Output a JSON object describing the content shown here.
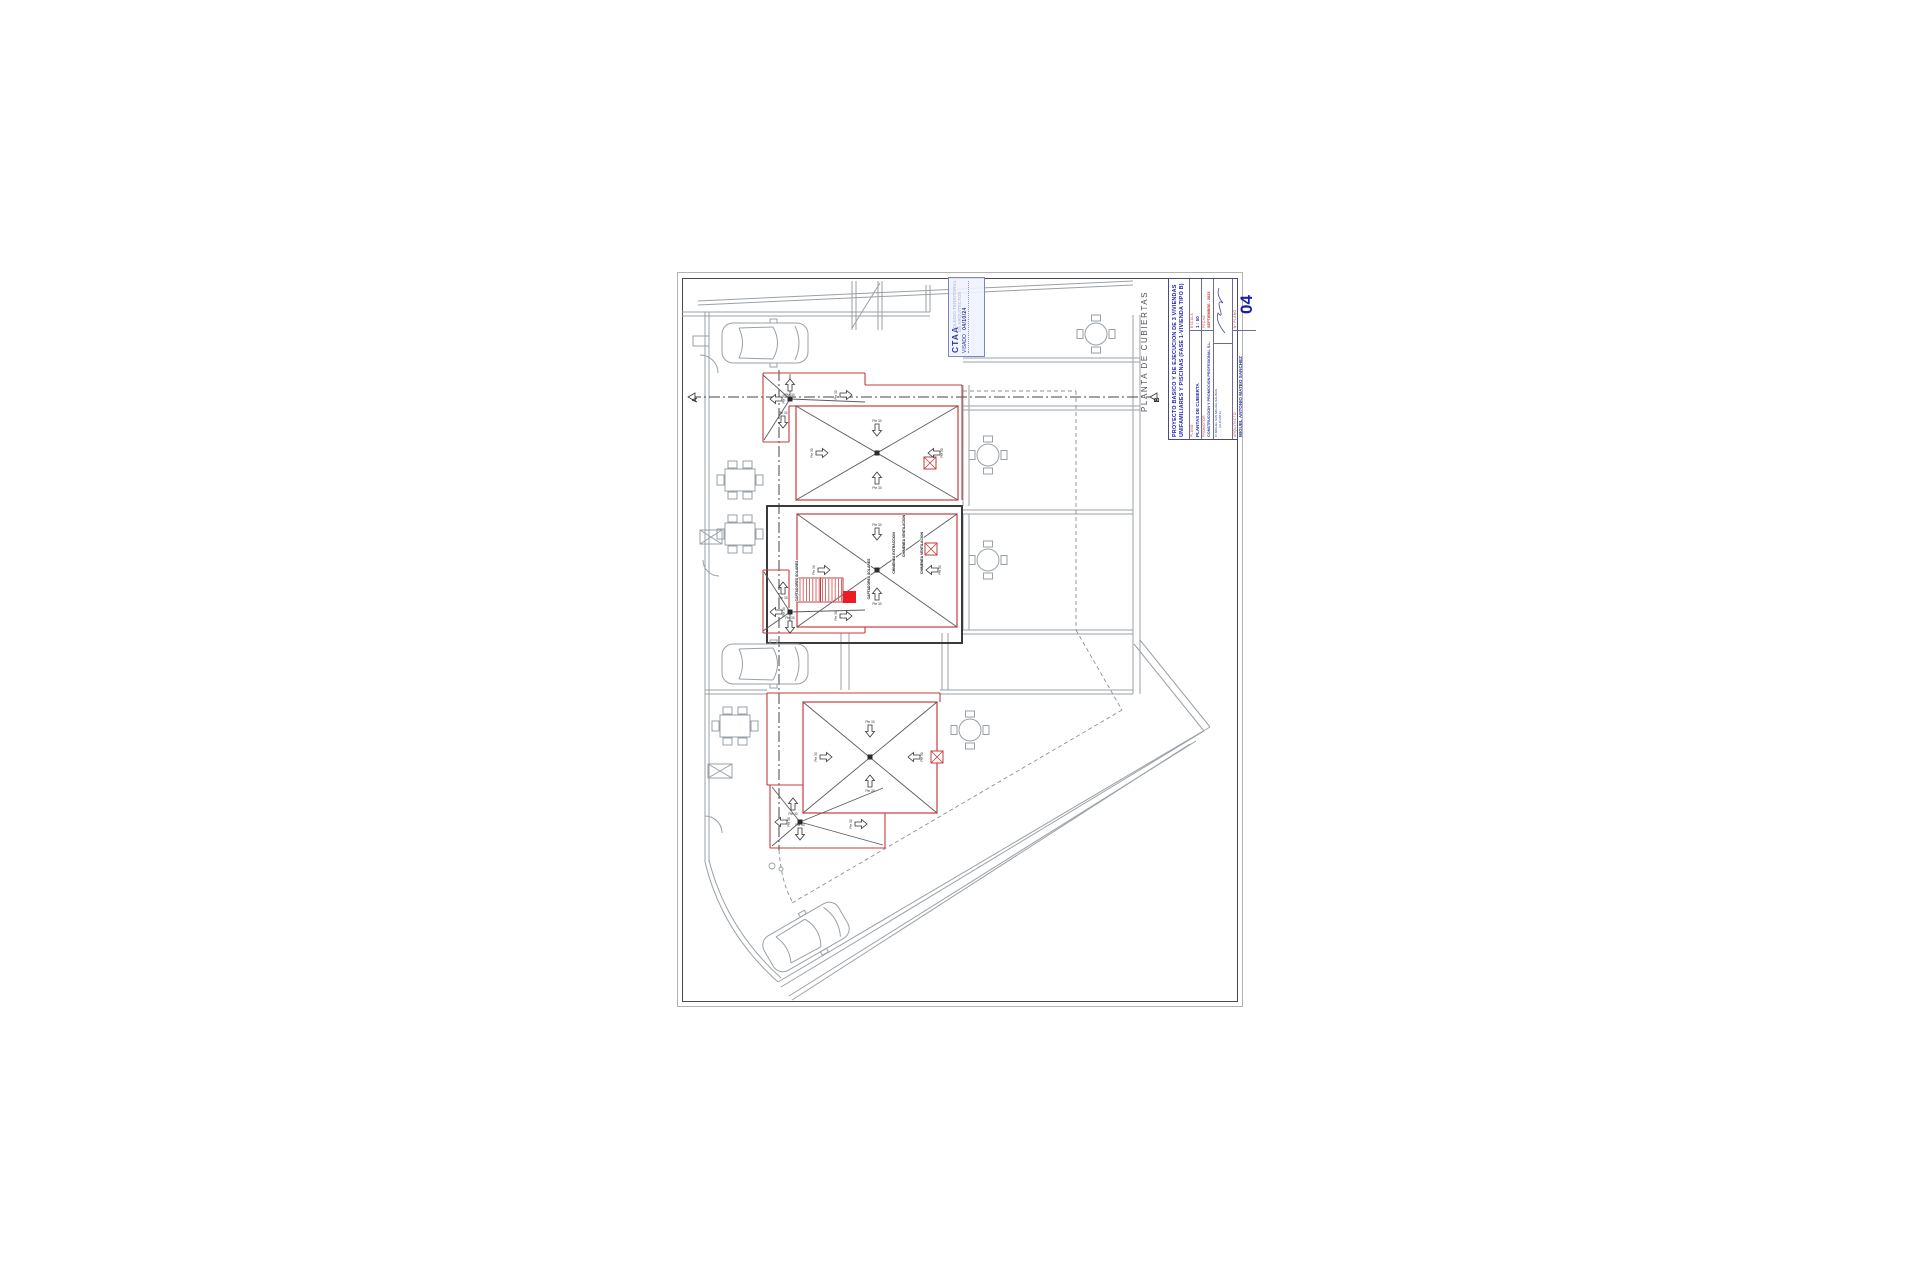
{
  "document": {
    "kind": "architectural roof plan sheet",
    "background": "#ffffff",
    "accent_red": "#c43c3c",
    "fill_red": "#ed1c24",
    "blue": "#1c1ca8"
  },
  "plan": {
    "label": "PLANTA DE CUBIERTAS",
    "slope_label": "Pte 30",
    "section_markers": {
      "left": "A",
      "right": "B"
    },
    "roof_tags": [
      {
        "x": 905,
        "y": 536,
        "text": "CHIMENEA VENTILACION"
      },
      {
        "x": 895,
        "y": 553,
        "text": "CHIMENEA EXTRACCION"
      },
      {
        "x": 923,
        "y": 553,
        "text": "CHIMENEA VENTILACION"
      },
      {
        "x": 870,
        "y": 579,
        "text": "CAPTADORES SOLARES"
      },
      {
        "x": 798,
        "y": 581,
        "text": "CAPTADORES SOLARES"
      }
    ],
    "geometry": {
      "gray_lines": [
        [
          698,
          301,
          1133,
          281
        ],
        [
          698,
          305,
          1133,
          285
        ],
        [
          682,
          312,
          930,
          312
        ],
        [
          682,
          316,
          930,
          316
        ],
        [
          705,
          312,
          705,
          862
        ],
        [
          709,
          312,
          709,
          862
        ],
        [
          852,
          281,
          852,
          330
        ],
        [
          856,
          281,
          856,
          330
        ],
        [
          878,
          281,
          878,
          330
        ],
        [
          882,
          281,
          882,
          330
        ],
        [
          926,
          285,
          926,
          312
        ],
        [
          930,
          285,
          930,
          312
        ],
        [
          852,
          328,
          880,
          283
        ],
        [
          963,
          358,
          1140,
          358
        ],
        [
          963,
          362,
          1140,
          362
        ],
        [
          1133,
          315,
          1133,
          694
        ],
        [
          1140,
          315,
          1140,
          694
        ],
        [
          962,
          406,
          1140,
          406
        ],
        [
          962,
          410,
          1140,
          410
        ],
        [
          962,
          510,
          1133,
          510
        ],
        [
          962,
          514,
          1133,
          514
        ],
        [
          962,
          630,
          1133,
          630
        ],
        [
          962,
          634,
          1133,
          634
        ],
        [
          940,
          690,
          1133,
          690
        ],
        [
          940,
          694,
          1133,
          694
        ],
        [
          705,
          690,
          767,
          690
        ],
        [
          705,
          694,
          767,
          694
        ],
        [
          963,
          385,
          963,
          506
        ],
        [
          969,
          385,
          969,
          506
        ],
        [
          963,
          514,
          963,
          630
        ],
        [
          969,
          514,
          969,
          630
        ],
        [
          841,
          633,
          841,
          690
        ],
        [
          849,
          633,
          849,
          690
        ],
        [
          942,
          633,
          942,
          690
        ],
        [
          948,
          633,
          948,
          690
        ],
        [
          1140,
          640,
          1210,
          727
        ],
        [
          1134,
          644,
          1204,
          731
        ],
        [
          778,
          982,
          1210,
          727
        ],
        [
          781,
          987,
          1204,
          731
        ],
        [
          789,
          996,
          1196,
          741
        ],
        [
          792,
          1000,
          1190,
          744
        ],
        [
          700,
          530,
          722,
          544
        ],
        [
          700,
          544,
          722,
          530
        ],
        [
          708,
          764,
          732,
          778
        ],
        [
          708,
          778,
          732,
          764
        ]
      ],
      "gray_rects": [
        [
          693,
          336,
          16,
          10
        ],
        [
          700,
          530,
          22,
          14
        ],
        [
          708,
          764,
          24,
          14
        ]
      ],
      "gray_paths": [
        "M700,355 a18,18 0 0 1 18,18",
        "M703,560 a16,16 0 0 0 16,16",
        "M705,816 a17,17 0 0 1 17,17",
        "M705,862 Q722,932 778,982",
        "M709,860 Q726,928 781,978"
      ],
      "dash_lines": [
        [
          963,
          391,
          1076,
          391
        ],
        [
          1076,
          391,
          1076,
          630
        ],
        [
          1076,
          630,
          1122,
          710
        ],
        [
          1122,
          710,
          792,
          903
        ]
      ],
      "dash_paths": [
        "M779,850 Q781,882 793,903"
      ],
      "dashdot_lines": [
        [
          690,
          397,
          1160,
          397
        ],
        [
          779,
          370,
          779,
          850
        ]
      ],
      "red_rects": [
        [
          796,
          406,
          162,
          94
        ],
        [
          797,
          514,
          160,
          113
        ],
        [
          803,
          702,
          134,
          111
        ]
      ],
      "red_lines": [
        [
          763,
          373,
          865,
          373
        ],
        [
          763,
          373,
          763,
          442
        ],
        [
          763,
          442,
          789,
          442
        ],
        [
          789,
          442,
          789,
          406
        ],
        [
          789,
          406,
          796,
          406
        ],
        [
          865,
          373,
          865,
          385
        ],
        [
          865,
          385,
          962,
          385
        ],
        [
          962,
          385,
          962,
          500
        ],
        [
          763,
          633,
          865,
          633
        ],
        [
          763,
          570,
          763,
          633
        ],
        [
          763,
          570,
          789,
          570
        ],
        [
          789,
          570,
          789,
          608
        ],
        [
          865,
          627,
          865,
          633
        ],
        [
          770,
          785,
          770,
          848
        ],
        [
          770,
          848,
          885,
          848
        ],
        [
          770,
          785,
          803,
          785
        ],
        [
          885,
          848,
          885,
          813
        ],
        [
          767,
          693,
          940,
          693
        ],
        [
          767,
          693,
          767,
          785
        ],
        [
          767,
          785,
          770,
          785
        ],
        [
          940,
          693,
          940,
          702
        ]
      ],
      "black_rects": [
        [
          767,
          506,
          195,
          137
        ]
      ],
      "thin_black": [
        [
          796,
          406,
          958,
          500
        ],
        [
          958,
          406,
          796,
          500
        ],
        [
          797,
          514,
          957,
          627
        ],
        [
          957,
          514,
          797,
          627
        ],
        [
          803,
          702,
          937,
          813
        ],
        [
          937,
          702,
          803,
          813
        ],
        [
          790,
          399,
          763,
          375
        ],
        [
          790,
          399,
          764,
          440
        ],
        [
          790,
          399,
          865,
          402
        ],
        [
          790,
          399,
          790,
          374
        ],
        [
          790,
          612,
          763,
          631
        ],
        [
          790,
          612,
          764,
          572
        ],
        [
          790,
          612,
          865,
          610
        ],
        [
          790,
          612,
          790,
          632
        ],
        [
          800,
          822,
          772,
          787
        ],
        [
          800,
          822,
          772,
          846
        ],
        [
          800,
          822,
          883,
          845
        ],
        [
          800,
          822,
          883,
          788
        ]
      ],
      "hatch": {
        "x": 798,
        "y": 578,
        "w": 45,
        "h": 24,
        "step": 3.2
      },
      "solid_red": [
        843,
        591,
        13,
        12
      ],
      "chimneys": [
        [
          924,
          457
        ],
        [
          925,
          543
        ],
        [
          931,
          751
        ]
      ],
      "dots": [
        [
          877,
          453
        ],
        [
          877,
          570
        ],
        [
          870,
          757
        ],
        [
          790,
          399
        ],
        [
          790,
          612
        ],
        [
          800,
          822
        ]
      ],
      "arrows": [
        {
          "x": 877,
          "y": 430,
          "r": 180
        },
        {
          "x": 877,
          "y": 478,
          "r": 0
        },
        {
          "x": 822,
          "y": 453,
          "r": 90
        },
        {
          "x": 934,
          "y": 453,
          "r": 270
        },
        {
          "x": 877,
          "y": 534,
          "r": 180
        },
        {
          "x": 877,
          "y": 594,
          "r": 0
        },
        {
          "x": 824,
          "y": 570,
          "r": 90
        },
        {
          "x": 932,
          "y": 570,
          "r": 270
        },
        {
          "x": 870,
          "y": 731,
          "r": 180
        },
        {
          "x": 870,
          "y": 781,
          "r": 0
        },
        {
          "x": 826,
          "y": 757,
          "r": 90
        },
        {
          "x": 914,
          "y": 757,
          "r": 270
        },
        {
          "x": 790,
          "y": 385,
          "r": 0
        },
        {
          "x": 776,
          "y": 399,
          "r": 270
        },
        {
          "x": 846,
          "y": 395,
          "r": 90
        },
        {
          "x": 783,
          "y": 422,
          "r": 180
        },
        {
          "x": 783,
          "y": 588,
          "r": 0
        },
        {
          "x": 776,
          "y": 612,
          "r": 270
        },
        {
          "x": 846,
          "y": 616,
          "r": 90
        },
        {
          "x": 790,
          "y": 627,
          "r": 180
        },
        {
          "x": 793,
          "y": 804,
          "r": 0
        },
        {
          "x": 781,
          "y": 822,
          "r": 270
        },
        {
          "x": 861,
          "y": 824,
          "r": 90
        },
        {
          "x": 800,
          "y": 834,
          "r": 180
        }
      ],
      "cars": [
        {
          "x": 765,
          "y": 343,
          "r": 0
        },
        {
          "x": 765,
          "y": 664,
          "r": 0
        },
        {
          "x": 806,
          "y": 937,
          "r": -30
        }
      ],
      "tables_rect": [
        [
          740,
          480
        ],
        [
          740,
          534
        ],
        [
          735,
          726
        ]
      ],
      "tables_round": [
        [
          1096,
          334
        ],
        [
          988,
          455
        ],
        [
          988,
          560
        ],
        [
          970,
          730
        ]
      ],
      "small_circles": [
        [
          772,
          866,
          3
        ],
        [
          781,
          869,
          2
        ]
      ],
      "marker_left": {
        "tri": [
          688,
          397
        ],
        "lx": 697,
        "ly": 400
      },
      "marker_right": {
        "tri": [
          1150,
          397
        ],
        "lx": 1159,
        "ly": 400
      }
    }
  },
  "stamp": {
    "org": "CTAA",
    "watermark_line1": "COLEGIO TERRITORIAL",
    "watermark_line2": "DE ARQUITECTOS",
    "status": "VISADO",
    "date": "04/10/24",
    "fine_print": "· · · · · · · · · · · · · · · · · · · ·"
  },
  "title_block": {
    "project_title_line1": "PROYECTO BASICO Y DE EJECUCION DE 3 VIVIENDAS",
    "project_title_line2": "UNIFAMILIARES Y PISCINAS (FASE 1-VIVIENDA TIPO B)",
    "plano_label": "PLANO",
    "plano_value": "PLANTAS DE CUBIERTA",
    "escala_label": "ESCALA",
    "escala_value": "1 : 50",
    "promotor_label": "PROMOTOR",
    "promotor_value": "CONSTRUCCION Y PROMOCION PROFESIONAL S.L.",
    "fecha_label": "FECHA",
    "fecha_value": "SEPTIEMBRE - 2023",
    "address_line1": "C/ MIGUEL SAN MIGUEL SALINAS",
    "address_line2": "· · · · · (ALICANTE)",
    "arquitecto_label": "ARQUITECTO",
    "arquitecto_value": "MIGUEL ANTONIO MATEO SANCHEZ",
    "arquitecto_fine": "· · · · · · · · · · · · · · · · · · · · · ·",
    "numero_label": "Nº PLANO",
    "sheet_number": "04"
  }
}
